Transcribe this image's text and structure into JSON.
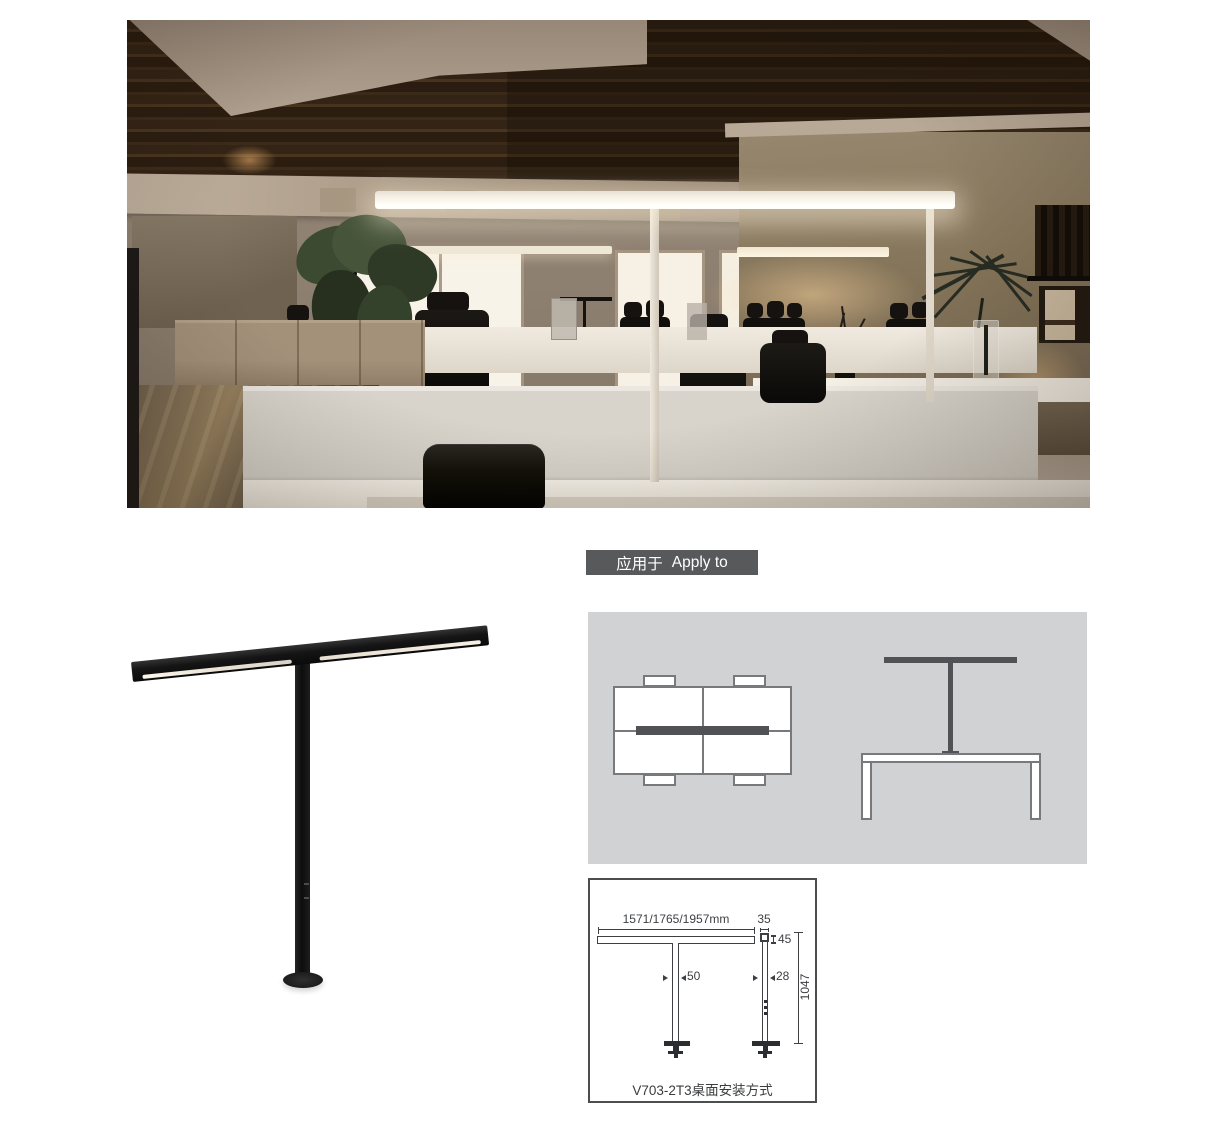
{
  "page": {
    "background": "#ffffff"
  },
  "apply_to": {
    "label_zh": "应用于",
    "label_en": "Apply to",
    "bg_color": "#58595b",
    "text_color": "#ffffff"
  },
  "application_panel": {
    "panel_bg": "#d1d2d4",
    "accent_color": "#505256"
  },
  "installation_drawing": {
    "caption": "V703-2T3桌面安装方式",
    "line_color": "#3d3f42",
    "dimensions": {
      "bar_length": "1571/1765/1957mm",
      "head_width": "35",
      "head_height": "45",
      "front_pole_width": "50",
      "side_pole_width": "28",
      "overall_height": "1047"
    }
  },
  "product": {
    "body_color": "#161616"
  }
}
